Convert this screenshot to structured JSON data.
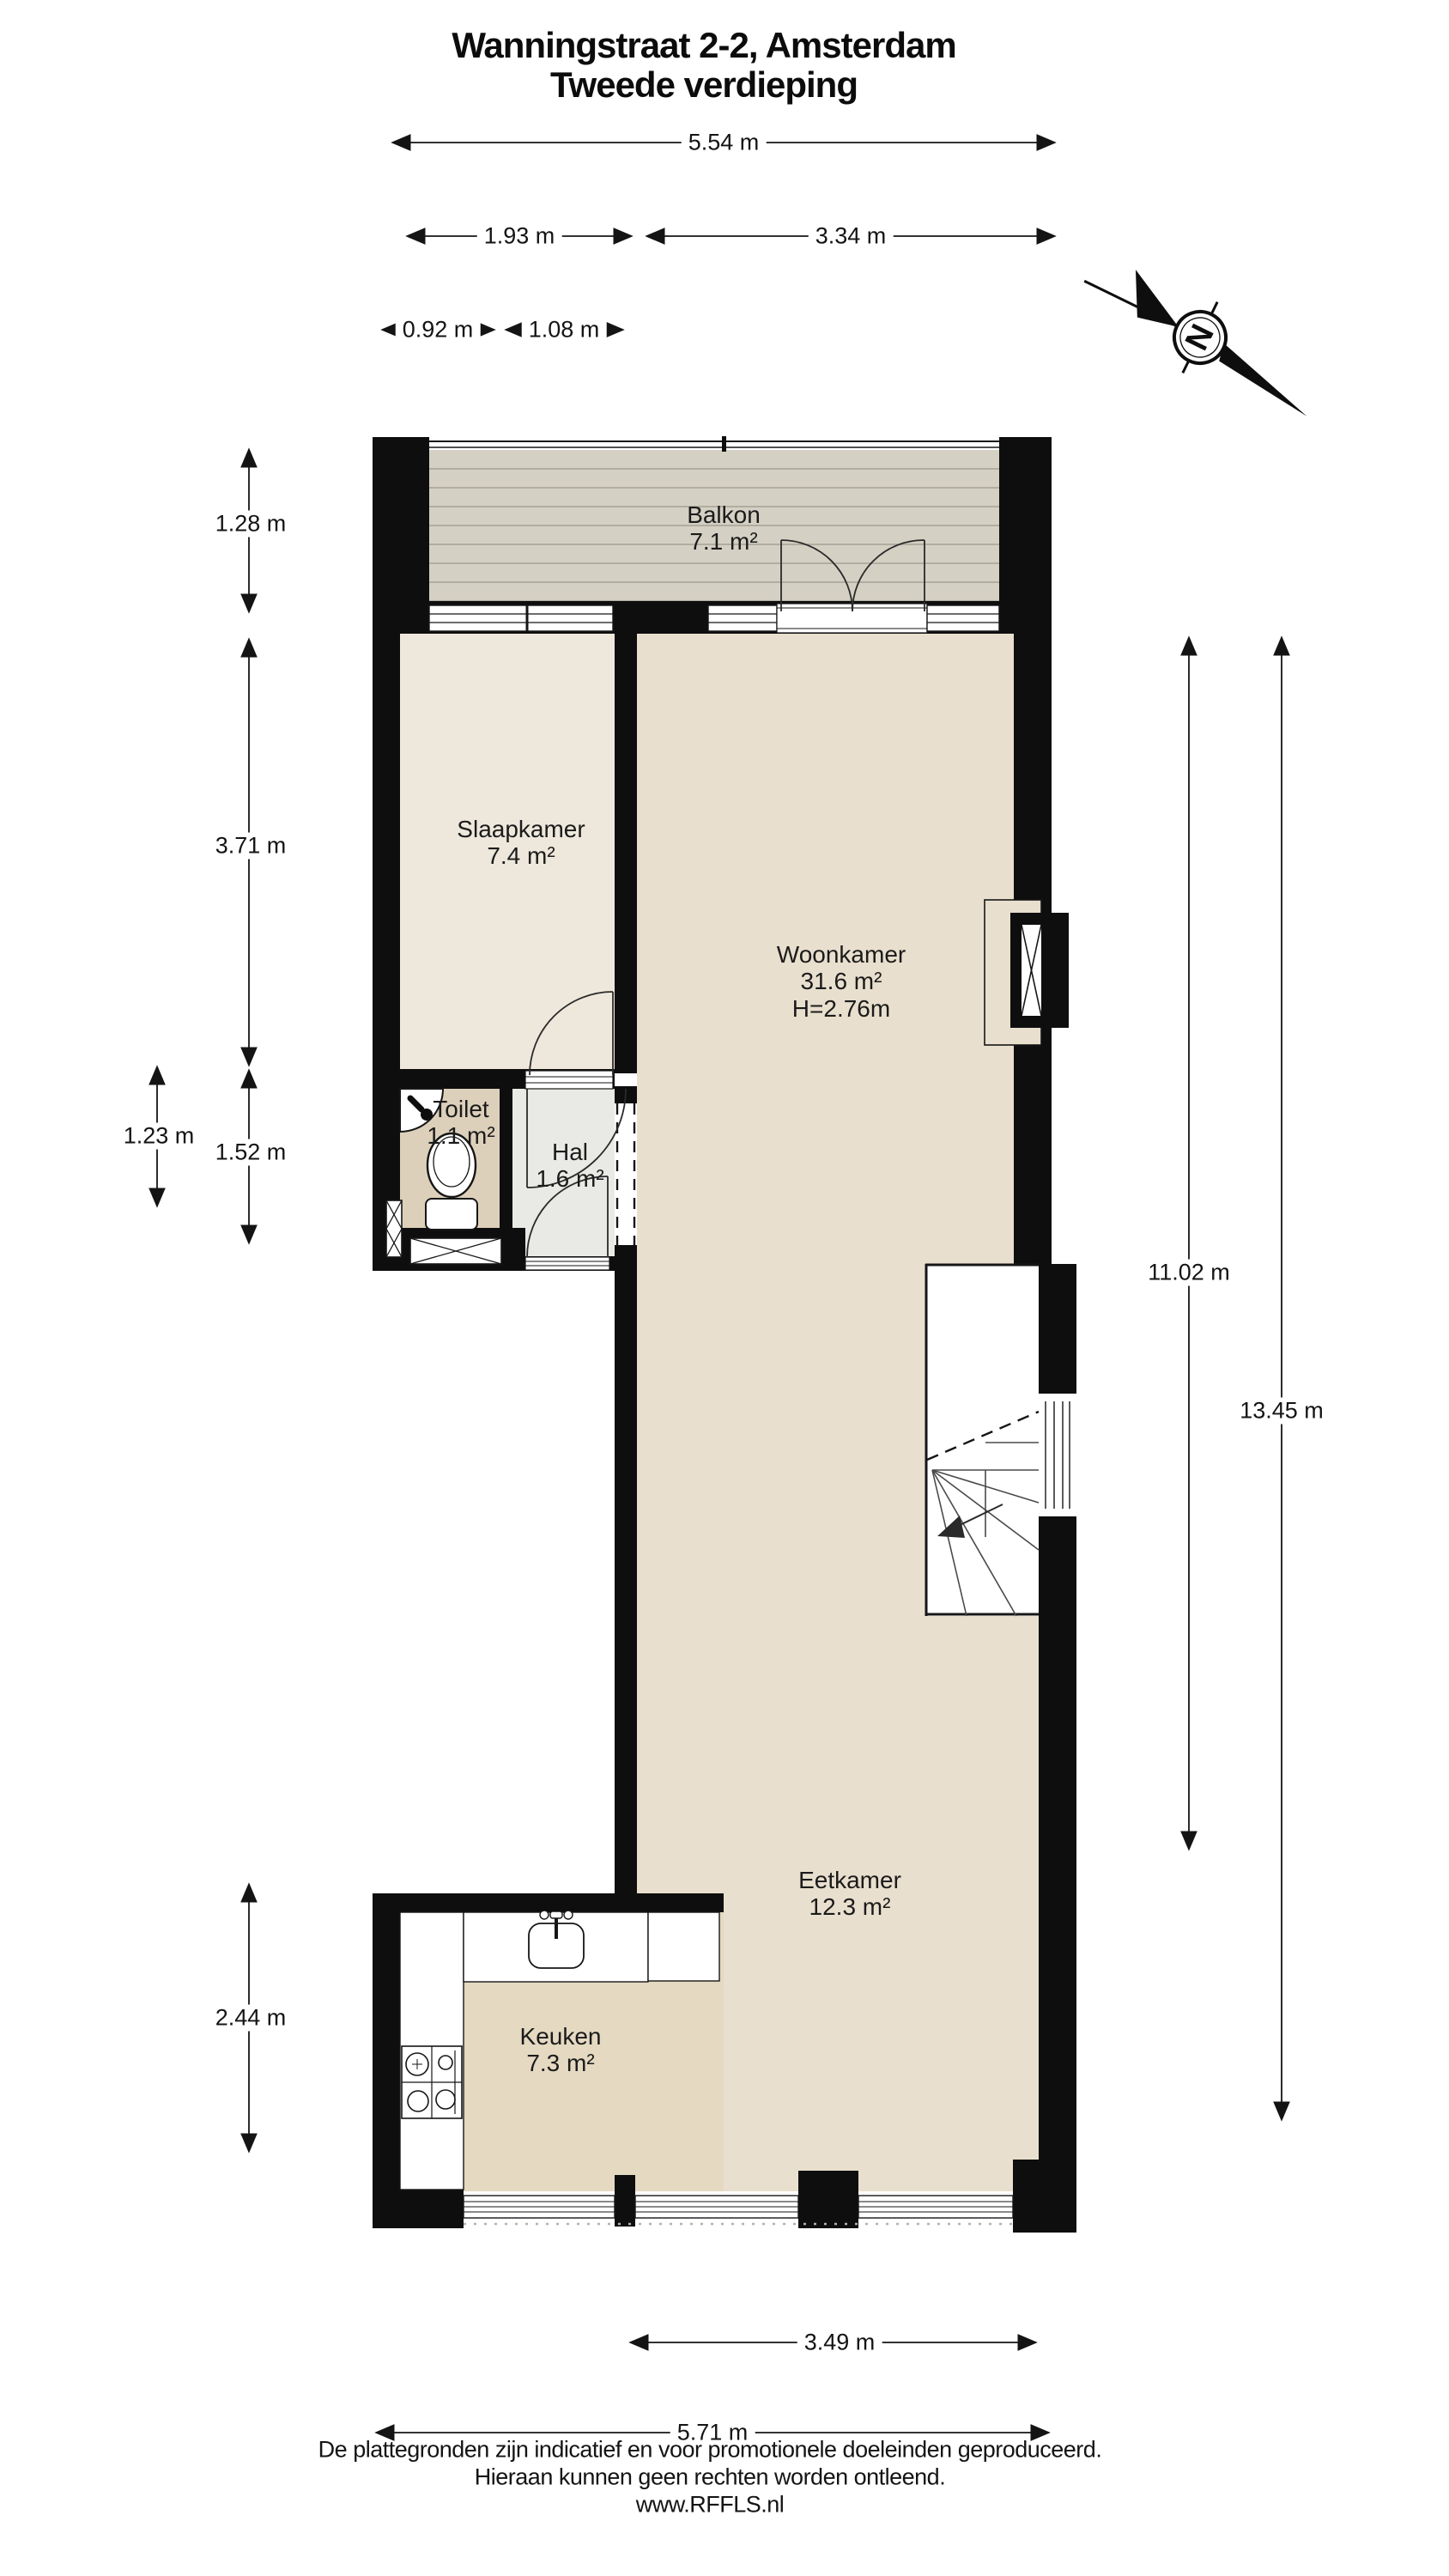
{
  "title": {
    "line1": "Wanningstraat 2-2, Amsterdam",
    "line2": "Tweede verdieping"
  },
  "rooms": {
    "balkon": {
      "name": "Balkon",
      "area": "7.1 m²"
    },
    "slaapkamer": {
      "name": "Slaapkamer",
      "area": "7.4 m²"
    },
    "woonkamer": {
      "name": "Woonkamer",
      "area": "31.6 m²",
      "height": "H=2.76m"
    },
    "toilet": {
      "name": "Toilet",
      "area": "1.1 m²"
    },
    "hal": {
      "name": "Hal",
      "area": "1.6 m²"
    },
    "eetkamer": {
      "name": "Eetkamer",
      "area": "12.3 m²"
    },
    "keuken": {
      "name": "Keuken",
      "area": "7.3 m²"
    }
  },
  "dims": {
    "top_total": "5.54 m",
    "top_left": "1.93 m",
    "top_right": "3.34 m",
    "top_sub_left": "0.92 m",
    "top_sub_right": "1.08 m",
    "left_balkon": "1.28 m",
    "left_slaap": "3.71 m",
    "left_toilet": "1.23 m",
    "left_hal": "1.52 m",
    "left_keuken": "2.44 m",
    "right_inner": "11.02 m",
    "right_outer": "13.45 m",
    "bottom_inner": "3.49 m",
    "bottom_total": "5.71 m"
  },
  "compass": {
    "letter": "N"
  },
  "footer": {
    "line1": "De plattegronden zijn indicatief en voor promotionele doeleinden geproduceerd.",
    "line2": "Hieraan kunnen geen rechten worden ontleend.",
    "line3": "www.RFFLS.nl"
  },
  "colors": {
    "wall": "#0e0e0e",
    "balkon_fill": "#d4d0c3",
    "plank_line": "#a5a296",
    "slaapkamer_fill": "#eee8dc",
    "woonkamer_fill": "#e9dfce",
    "keuken_fill": "#e5d9c2",
    "toilet_fill": "#ddd0ba",
    "hal_fill": "#e9e9e5",
    "line": "#161616"
  }
}
